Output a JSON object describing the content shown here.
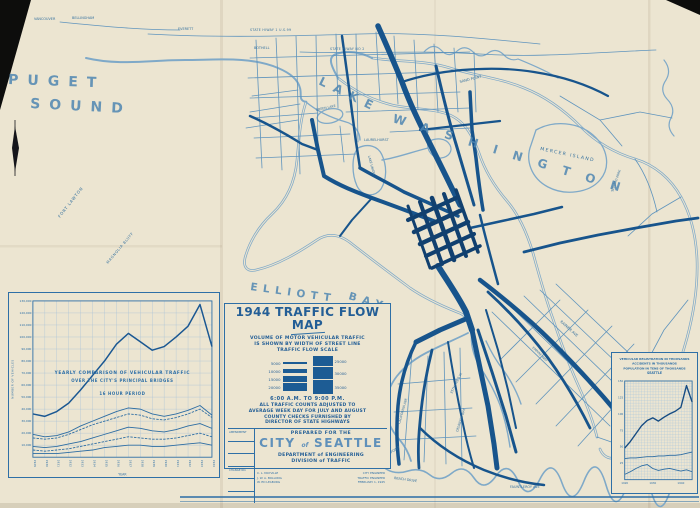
{
  "sheet_name": "1944 Seattle Traffic Flow Map (scanned print)",
  "colors": {
    "paper": "#ece5d1",
    "ink": "#2e6fa6",
    "ink_dark": "#17548c",
    "water": "#7fa9c8",
    "photo_black": "#0d0d0c"
  },
  "map_labels": {
    "puget": "PUGET",
    "sound": "SOUND",
    "lake": "LAKE",
    "washington": "WASHINGTON",
    "elliott": "ELLIOTT",
    "bay": "BAY",
    "mercer_island": "MERCER ISLAND",
    "fort_lawton": "FORT LAWTON",
    "magnolia_bluff": "MAGNOLIA BLUFF",
    "green_lake": "GREEN LAKE",
    "lake_union": "LAKE UNION",
    "laurelhurst": "LAURELHURST",
    "sand_point": "SAND POINT",
    "seward_park": "SEWARD PARK",
    "vancouver": "VANCOUVER",
    "bellingham": "BELLINGHAM",
    "everett": "EVERETT",
    "bothell": "BOTHELL",
    "state_hiway_1": "STATE HIWAY 1 U.S.99",
    "state_hiway_2": "STATE HIWAY NO 2",
    "rainier_ave": "RAINIER AVE",
    "empire_way": "EMPIRE WAY",
    "alki_point": "ALKI POINT",
    "beach_drive": "BEACH DRIVE",
    "fauntleroy_ave": "FAUNTLEROY AVE",
    "ave_35th": "35TH AVE S.W.",
    "california_ave": "CALIFORNIA AVE",
    "delridge_way": "DELRIDGE WAY"
  },
  "title_block": {
    "title": "1944 TRAFFIC FLOW MAP",
    "desc_line1": "VOLUME OF MOTOR VEHICULAR TRAFFIC",
    "desc_line2": "IS SHOWN BY WIDTH OF STREET LINE",
    "scale_heading": "TRAFFIC FLOW SCALE",
    "scale_left_labels": [
      "5000",
      "10000",
      "15000",
      "20000"
    ],
    "scale_right_labels": [
      "25000",
      "30000",
      "35000"
    ],
    "time_range": "6:00 A.M. TO 9:00 P.M.",
    "note_line1": "ALL TRAFFIC COUNTS ADJUSTED TO",
    "note_line2": "AVERAGE WEEK DAY FOR JULY AND AUGUST",
    "note_line3": "COUNTY CHECKS FURNISHED BY",
    "note_line4": "DIRECTOR OF STATE HIGHWAYS",
    "amendment_label": "AMENDMENT",
    "change_label": "CHANGE NO.",
    "prepared_for": "PREPARED FOR THE",
    "city_word": "CITY",
    "of_word": "of",
    "seattle_word": "SEATTLE",
    "department": "DEPARTMENT of ENGINEERING",
    "division": "DIVISION of TRAFFIC",
    "signature_names": [
      "C. L. MAYVILLE",
      "J. W. A. BOLLONG",
      "W. ED LEABURG"
    ],
    "signature_titles": [
      "CITY ENGINEER",
      "TRAFFIC ENGINEER",
      "FEBRUARY 1, 1945"
    ]
  },
  "chart_data": [
    {
      "type": "line",
      "title": "YEARLY COMPARISON OF VEHICULAR TRAFFIC",
      "subtitle": "OVER THE CITY'S PRINCIPAL BRIDGES",
      "note": "16 HOUR PERIOD",
      "xlabel": "YEAR",
      "ylabel": "NUMBER OF VEHICLES",
      "x": [
        1929,
        1930,
        1931,
        1932,
        1933,
        1934,
        1935,
        1936,
        1937,
        1938,
        1939,
        1940,
        1941,
        1942,
        1943,
        1944
      ],
      "ylim": [
        0,
        130000
      ],
      "yticks": [
        10000,
        20000,
        30000,
        40000,
        50000,
        60000,
        70000,
        80000,
        90000,
        100000,
        110000,
        120000,
        130000
      ],
      "grid": true,
      "legend": "none",
      "series": [
        {
          "name": "total-all-bridges",
          "values": [
            36000,
            34000,
            38000,
            45000,
            56000,
            68000,
            80000,
            94000,
            103000,
            96000,
            89000,
            92000,
            100000,
            109000,
            127000,
            92000
          ]
        },
        {
          "name": "line-2",
          "values": [
            19000,
            17000,
            18000,
            21000,
            26000,
            30000,
            34000,
            38000,
            41000,
            40000,
            36000,
            34000,
            36000,
            39000,
            43000,
            35000
          ]
        },
        {
          "name": "line-3",
          "values": [
            16000,
            15000,
            16000,
            19000,
            23000,
            27000,
            30000,
            33000,
            36000,
            35000,
            32000,
            31000,
            33000,
            36000,
            40000,
            33000
          ]
        },
        {
          "name": "line-4",
          "values": [
            9000,
            8000,
            9000,
            11000,
            13000,
            16000,
            19000,
            22000,
            25000,
            24000,
            22000,
            21000,
            23000,
            26000,
            28000,
            24000
          ]
        },
        {
          "name": "line-5",
          "values": [
            6000,
            5000,
            6000,
            7000,
            9000,
            11000,
            13000,
            15000,
            17000,
            16000,
            15000,
            15000,
            16000,
            18000,
            20000,
            17000
          ]
        },
        {
          "name": "line-6",
          "values": [
            3000,
            3000,
            3000,
            4000,
            5000,
            6000,
            8000,
            9000,
            10000,
            10000,
            9000,
            9000,
            10000,
            11000,
            12000,
            10000
          ]
        }
      ]
    },
    {
      "type": "line",
      "title_lines": [
        "VEHICULAR REGISTRATION IN THOUSANDS",
        "ACCIDENTS IN THOUSANDS",
        "POPULATION IN TENS OF THOUSANDS",
        "SEATTLE"
      ],
      "x": [
        1920,
        1922,
        1924,
        1926,
        1928,
        1930,
        1932,
        1934,
        1936,
        1938,
        1940,
        1942,
        1944
      ],
      "xticks": [
        1920,
        1930,
        1940
      ],
      "ylim": [
        0,
        150
      ],
      "yticks": [
        25,
        50,
        75,
        100,
        125,
        150
      ],
      "grid": true,
      "legend": "none",
      "series": [
        {
          "name": "registration",
          "values": [
            48,
            58,
            70,
            82,
            90,
            94,
            89,
            95,
            100,
            104,
            110,
            143,
            118
          ]
        },
        {
          "name": "population",
          "values": [
            32,
            33,
            33,
            34,
            35,
            35,
            36,
            36,
            37,
            37,
            38,
            40,
            42
          ]
        },
        {
          "name": "accidents",
          "values": [
            8,
            12,
            17,
            21,
            23,
            17,
            14,
            16,
            17,
            15,
            13,
            15,
            12
          ]
        }
      ]
    }
  ]
}
